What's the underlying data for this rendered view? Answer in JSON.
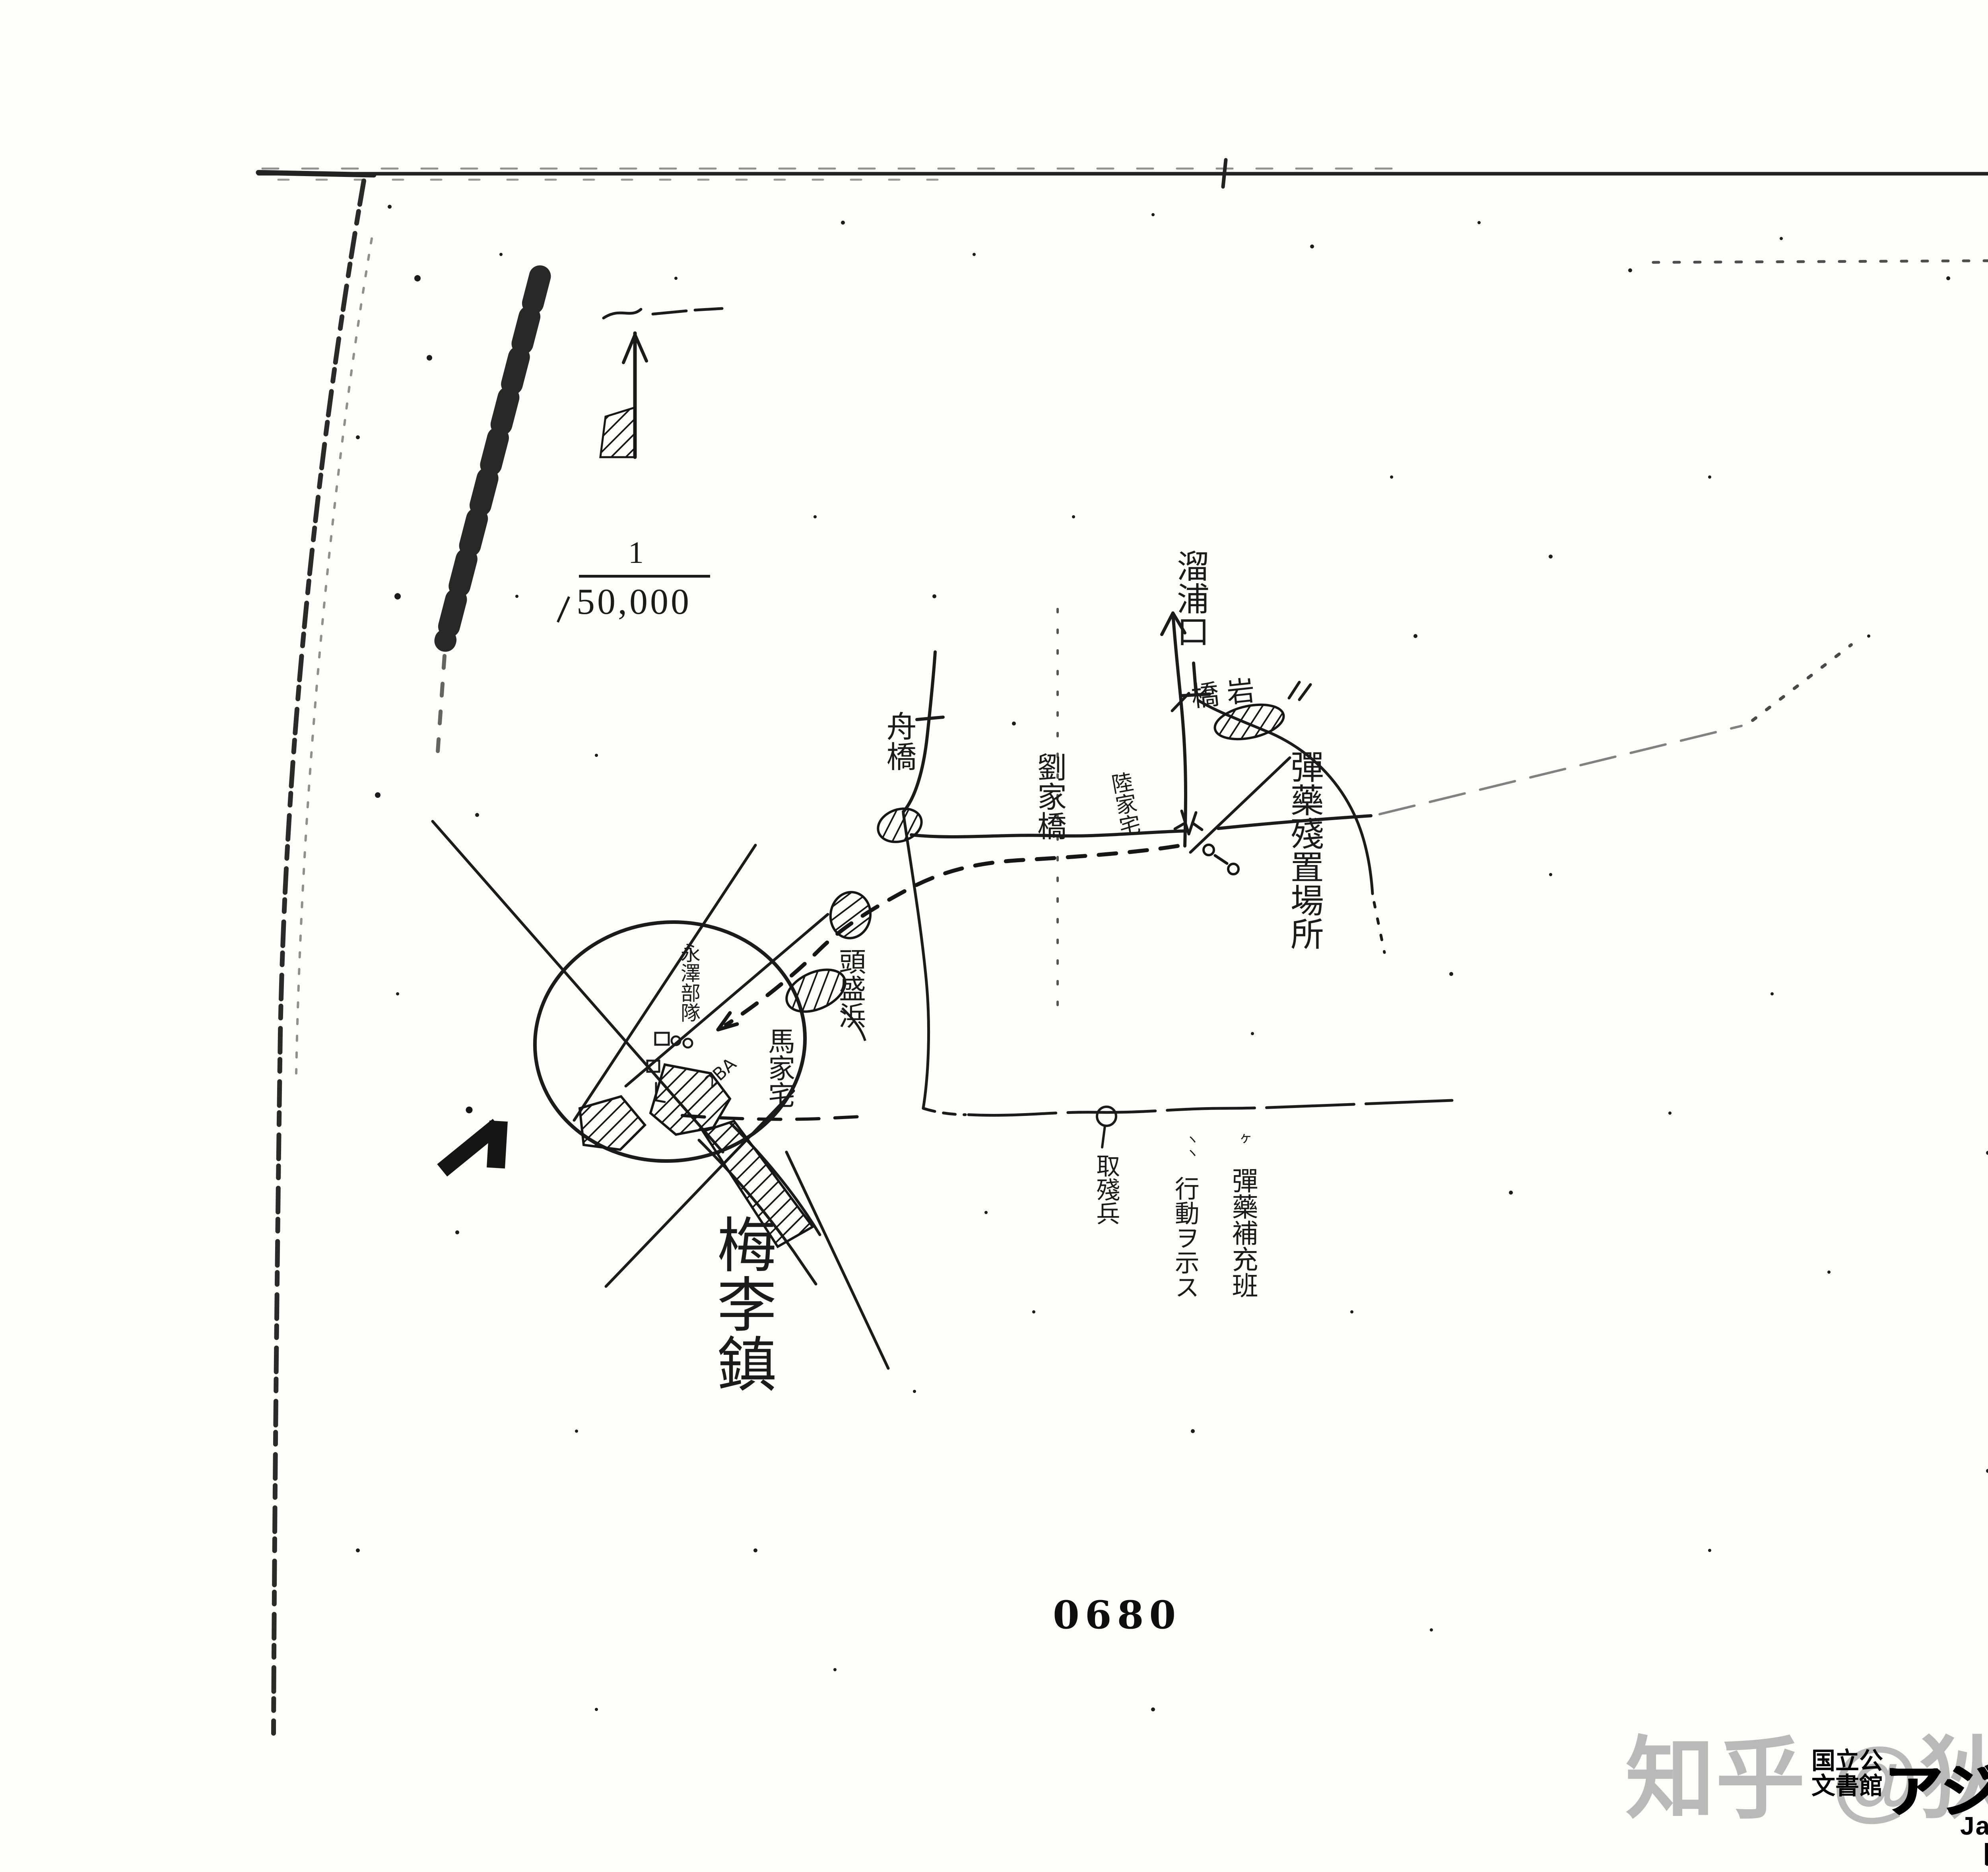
{
  "document": {
    "page_stamp": "0680"
  },
  "map": {
    "scale": {
      "numerator": "1",
      "denominator": "50,000"
    },
    "place_labels": [
      {
        "id": "ryuhoko",
        "text": "溜浦口"
      },
      {
        "id": "kyogan",
        "text": "橋岩"
      },
      {
        "id": "funabashi",
        "text": "舟橋"
      },
      {
        "id": "ryukakyo",
        "text": "劉家橋"
      },
      {
        "id": "rikukataku",
        "text": "陸家宅"
      },
      {
        "id": "touseihama",
        "text": "頭盛浜"
      },
      {
        "id": "bakataku",
        "text": "馬家宅"
      },
      {
        "id": "bairichin",
        "text": "梅李鎮"
      },
      {
        "id": "eitakubutai",
        "text": "永澤部隊"
      }
    ],
    "annotations": [
      {
        "id": "danyaku-zanchi",
        "text": "彈藥殘置場所"
      },
      {
        "id": "shuzanhei",
        "text": "取殘兵"
      },
      {
        "id": "danyaku-hoju-han",
        "text": "彈藥補充班"
      },
      {
        "id": "kodo-wo-shimesu",
        "text": "行動ヲ示ス"
      },
      {
        "id": "tick-marks-right",
        "text": "ヶ"
      },
      {
        "id": "tick-marks-left",
        "text": "ヽヽ"
      },
      {
        "id": "scribble",
        "text": "2BA"
      }
    ]
  },
  "watermark": {
    "text": "知乎 @狄仁杰隔壁邻居"
  },
  "footer": {
    "org_line1": "国立公",
    "org_line2": "文書館",
    "jp_title": "アジア歴史資料センター…",
    "en_title": "Japan Center for Asian Historical Records",
    "url": "http://www.jacar.go.jp"
  }
}
